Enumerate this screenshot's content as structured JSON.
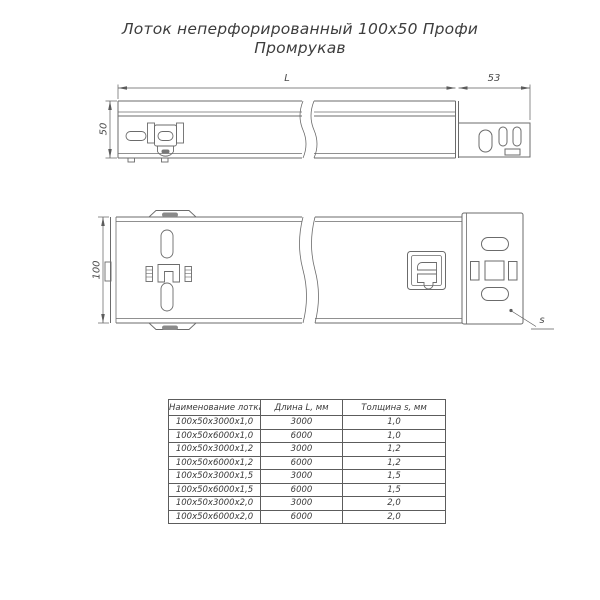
{
  "title": {
    "line1": "Лоток неперфорированный 100х50 Профи",
    "line2": "Промрукав"
  },
  "drawing": {
    "dims": {
      "length": "L",
      "end_section_width": "53",
      "side_height": "50",
      "plan_width": "100",
      "thickness": "s"
    }
  },
  "table": {
    "headers": [
      "Наименование лотка",
      "Длина L, мм",
      "Толщина s, мм"
    ],
    "rows": [
      [
        "100х50х3000х1,0",
        "3000",
        "1,0"
      ],
      [
        "100х50х6000х1,0",
        "6000",
        "1,0"
      ],
      [
        "100х50х3000х1,2",
        "3000",
        "1,2"
      ],
      [
        "100х50х6000х1,2",
        "6000",
        "1,2"
      ],
      [
        "100х50х3000х1,5",
        "3000",
        "1,5"
      ],
      [
        "100х50х6000х1,5",
        "6000",
        "1,5"
      ],
      [
        "100х50х3000х2,0",
        "3000",
        "2,0"
      ],
      [
        "100х50х6000х2,0",
        "6000",
        "2,0"
      ]
    ]
  },
  "colors": {
    "background": "#ffffff",
    "line": "#6b6b6b",
    "dim_line": "#5c5c5c",
    "text": "#3d3d3d"
  }
}
